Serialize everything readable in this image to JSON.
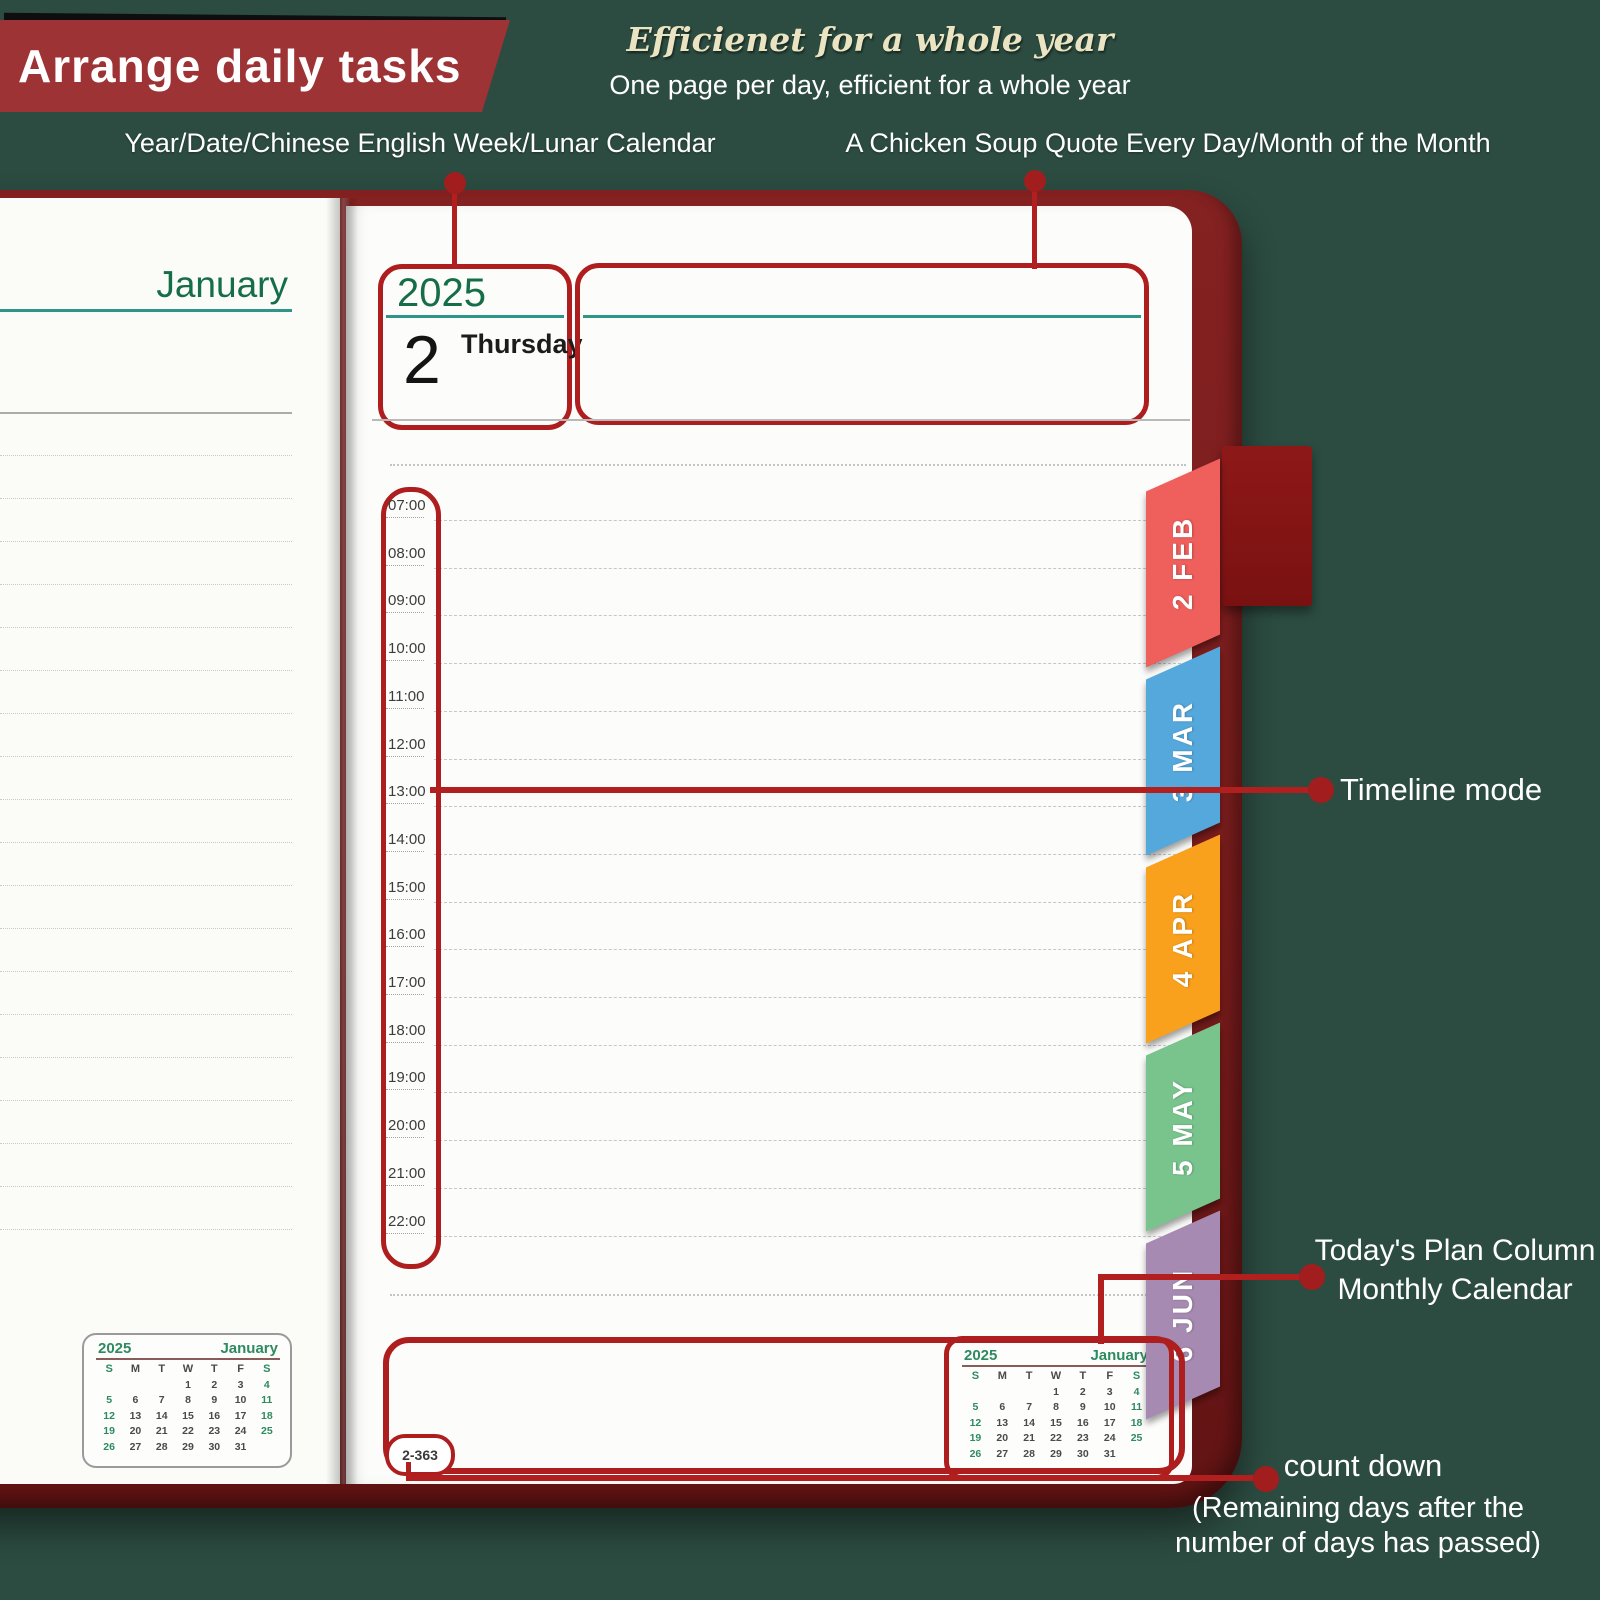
{
  "banner": {
    "title": "Arrange daily tasks"
  },
  "header": {
    "tagline": "Efficienet for a whole year",
    "subtitle": "One page per day, efficient for a whole year",
    "callout_left": "Year/Date/Chinese English Week/Lunar Calendar",
    "callout_right": "A Chicken Soup Quote Every Day/Month of the Month"
  },
  "left_page": {
    "month_title": "January"
  },
  "right_page": {
    "year": "2025",
    "day_number": "2",
    "weekday": "Thursday",
    "times": [
      "07:00",
      "08:00",
      "09:00",
      "10:00",
      "11:00",
      "12:00",
      "13:00",
      "14:00",
      "15:00",
      "16:00",
      "17:00",
      "18:00",
      "19:00",
      "20:00",
      "21:00",
      "22:00"
    ],
    "countdown": "2-363"
  },
  "tabs": [
    {
      "label": "2 FEB",
      "color": "#ef5f5c"
    },
    {
      "label": "3 MAR",
      "color": "#55a8dc"
    },
    {
      "label": "4 APR",
      "color": "#f9a11d"
    },
    {
      "label": "5 MAY",
      "color": "#79c48d"
    },
    {
      "label": "6 JUN",
      "color": "#a78ab2"
    }
  ],
  "annotations": {
    "timeline_mode": "Timeline mode",
    "plan_line1": "Today's Plan Column",
    "plan_line2": "Monthly Calendar",
    "countdown_line1": "count down",
    "countdown_line2": "(Remaining days after the",
    "countdown_line3": "number of days has passed)"
  },
  "mini_calendar": {
    "year": "2025",
    "month": "January",
    "day_headers": [
      "S",
      "M",
      "T",
      "W",
      "T",
      "F",
      "S"
    ],
    "weeks": [
      [
        "",
        "",
        "",
        "1",
        "2",
        "3",
        "4"
      ],
      [
        "5",
        "6",
        "7",
        "8",
        "9",
        "10",
        "11"
      ],
      [
        "12",
        "13",
        "14",
        "15",
        "16",
        "17",
        "18"
      ],
      [
        "19",
        "20",
        "21",
        "22",
        "23",
        "24",
        "25"
      ],
      [
        "26",
        "27",
        "28",
        "29",
        "30",
        "31",
        ""
      ]
    ]
  },
  "colors": {
    "background_green": "#2c4c41",
    "annotation_red": "#b11f1f",
    "banner_red": "#9d3334",
    "cover_maroon": "#7a1c1c",
    "teal_line": "#2e9688",
    "green_text": "#156e47"
  }
}
